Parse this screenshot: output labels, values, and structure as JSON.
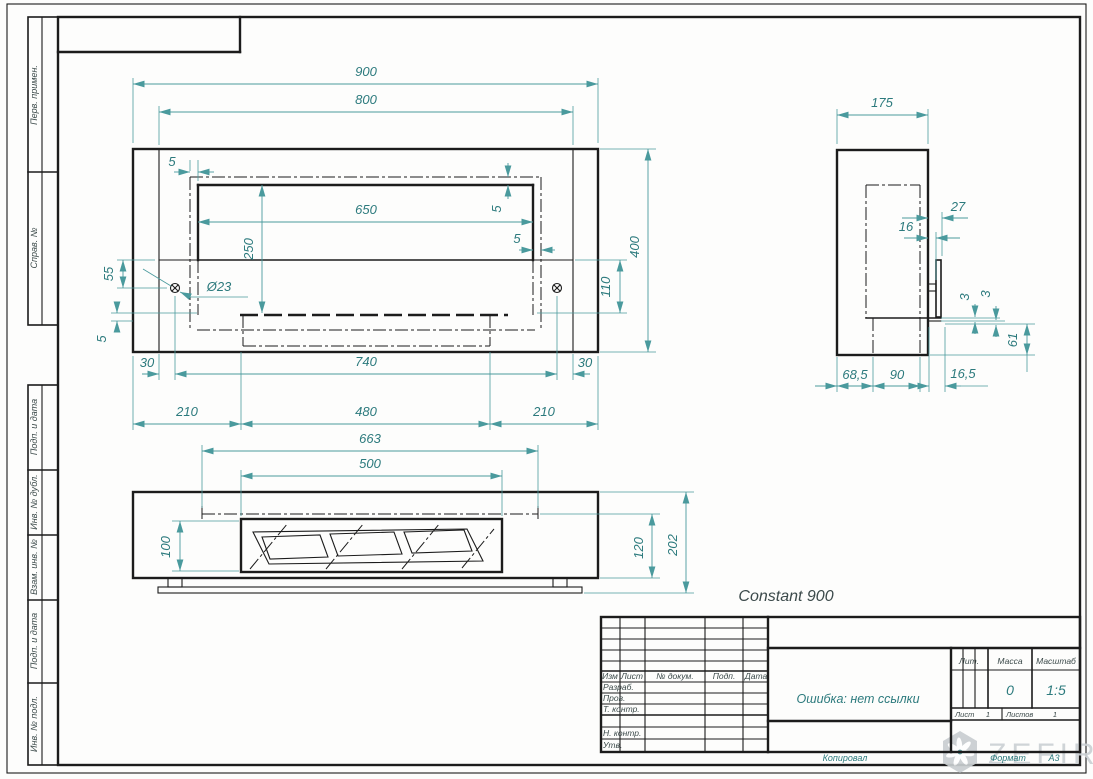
{
  "product_title": "Constant 900",
  "margin_labels": [
    "Перв. примен.",
    "Справ. №",
    "Подп. и дата",
    "Инв. № дубл.",
    "Взам. инв. №",
    "Подп. и дата",
    "Инв. № подл."
  ],
  "front_view": {
    "dims": {
      "w_overall": "900",
      "w_body": "800",
      "w_opening": "650",
      "h_opening": "250",
      "gap_top_left": "5",
      "inset_right_v": "5",
      "inset_right_h": "5",
      "hole_offset_v": "55",
      "gap_bottom_left": "5",
      "hole_dia": "Ø23",
      "h_shelf": "110",
      "h_overall": "400",
      "m_left": "30",
      "hole_span": "740",
      "m_right": "30",
      "b_left": "210",
      "b_center": "480",
      "b_right": "210"
    }
  },
  "bottom_view": {
    "dims": {
      "w_inner": "663",
      "w_slot": "500",
      "slot_depth": "100",
      "d_inner": "120",
      "d_overall": "202"
    }
  },
  "side_view": {
    "dims": {
      "depth": "175",
      "bracket_out": "27",
      "bracket_in": "16",
      "plate_a": "3",
      "plate_b": "3",
      "flange_h": "61",
      "b1": "68,5",
      "b2": "90",
      "b3": "16,5"
    }
  },
  "title_block": {
    "cols": [
      "Изм",
      "Лист",
      "№ докум.",
      "Подп.",
      "Дата"
    ],
    "rows": [
      "Разраб.",
      "Пров.",
      "Т. контр.",
      "Н. контр.",
      "Утв."
    ],
    "doc_name": "Ошибка: нет ссылки",
    "lit_label": "Лит.",
    "mass_label": "Масса",
    "scale_label": "Масштаб",
    "mass_value": "0",
    "scale_value": "1:5",
    "sheet_label": "Лист",
    "sheet_value": "1",
    "sheets_label": "Листов",
    "sheets_value": "1"
  },
  "footer": {
    "copied_by": "Копировал",
    "format_label": "Формат",
    "format_value": "A3"
  },
  "logo": {
    "text": "ZEFIRE"
  },
  "colors": {
    "line": "#1c1c1c",
    "dim_line": "#4a9a9d",
    "dim_text": "#2c7a7d",
    "stamp_text": "#3d4b4b",
    "logo_gray": "#ccd1d4"
  }
}
